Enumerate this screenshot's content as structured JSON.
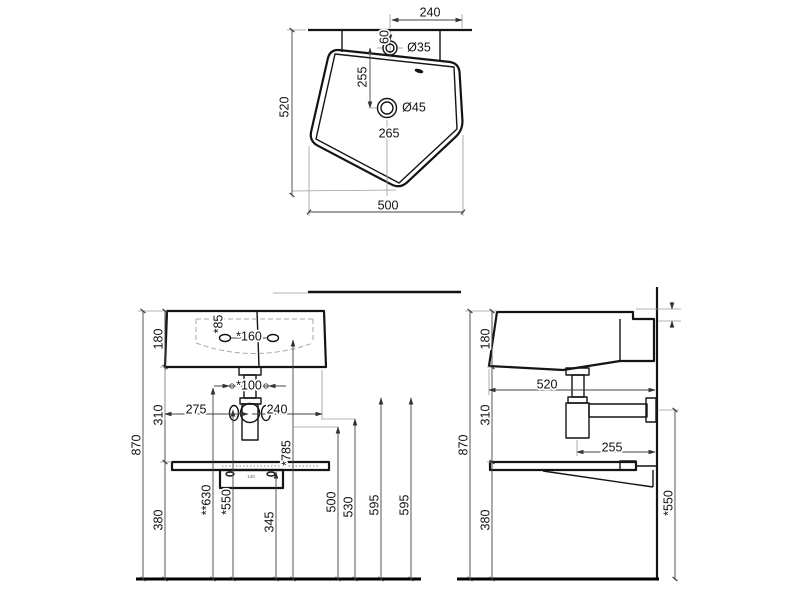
{
  "drawing": {
    "subject": "wall-mounted washbasin technical drawing, three orthographic views with dimensions (mm)",
    "colors": {
      "line": "#141414",
      "dim_line": "#444444",
      "extension_line": "#9a9a9a",
      "background": "#ffffff"
    },
    "views": {
      "top": {
        "label": "plan view",
        "dims": {
          "overall_width": "500",
          "overall_depth": "520",
          "tap_span": "240",
          "wall_to_tap": "60",
          "tap_hole_diameter": "Ø35",
          "tap_to_drain": "255",
          "drain_diameter": "Ø45",
          "drain_position": "265"
        }
      },
      "front": {
        "label": "front elevation",
        "dims": {
          "basin_height": "180",
          "basin_to_shelf": "310",
          "shelf_to_floor": "380",
          "overall_height": "870",
          "rim_to_holes": "*85",
          "hole_spacing": "*160",
          "fixing_spacing": "*100",
          "left_to_trap": "275",
          "trap_to_right": "240",
          "height_630": "**630",
          "height_550": "*550",
          "height_345": "345",
          "height_785": "*785",
          "height_500": "500",
          "height_530": "530",
          "height_595_a": "595",
          "height_595_b": "595",
          "bracket_hole_spacing": "140"
        }
      },
      "side": {
        "label": "side elevation",
        "dims": {
          "basin_height": "180",
          "basin_to_shelf": "310",
          "shelf_to_floor": "380",
          "overall_height": "870",
          "basin_depth": "520",
          "trap_to_wall": "255",
          "outlet_height": "*550"
        }
      }
    }
  }
}
